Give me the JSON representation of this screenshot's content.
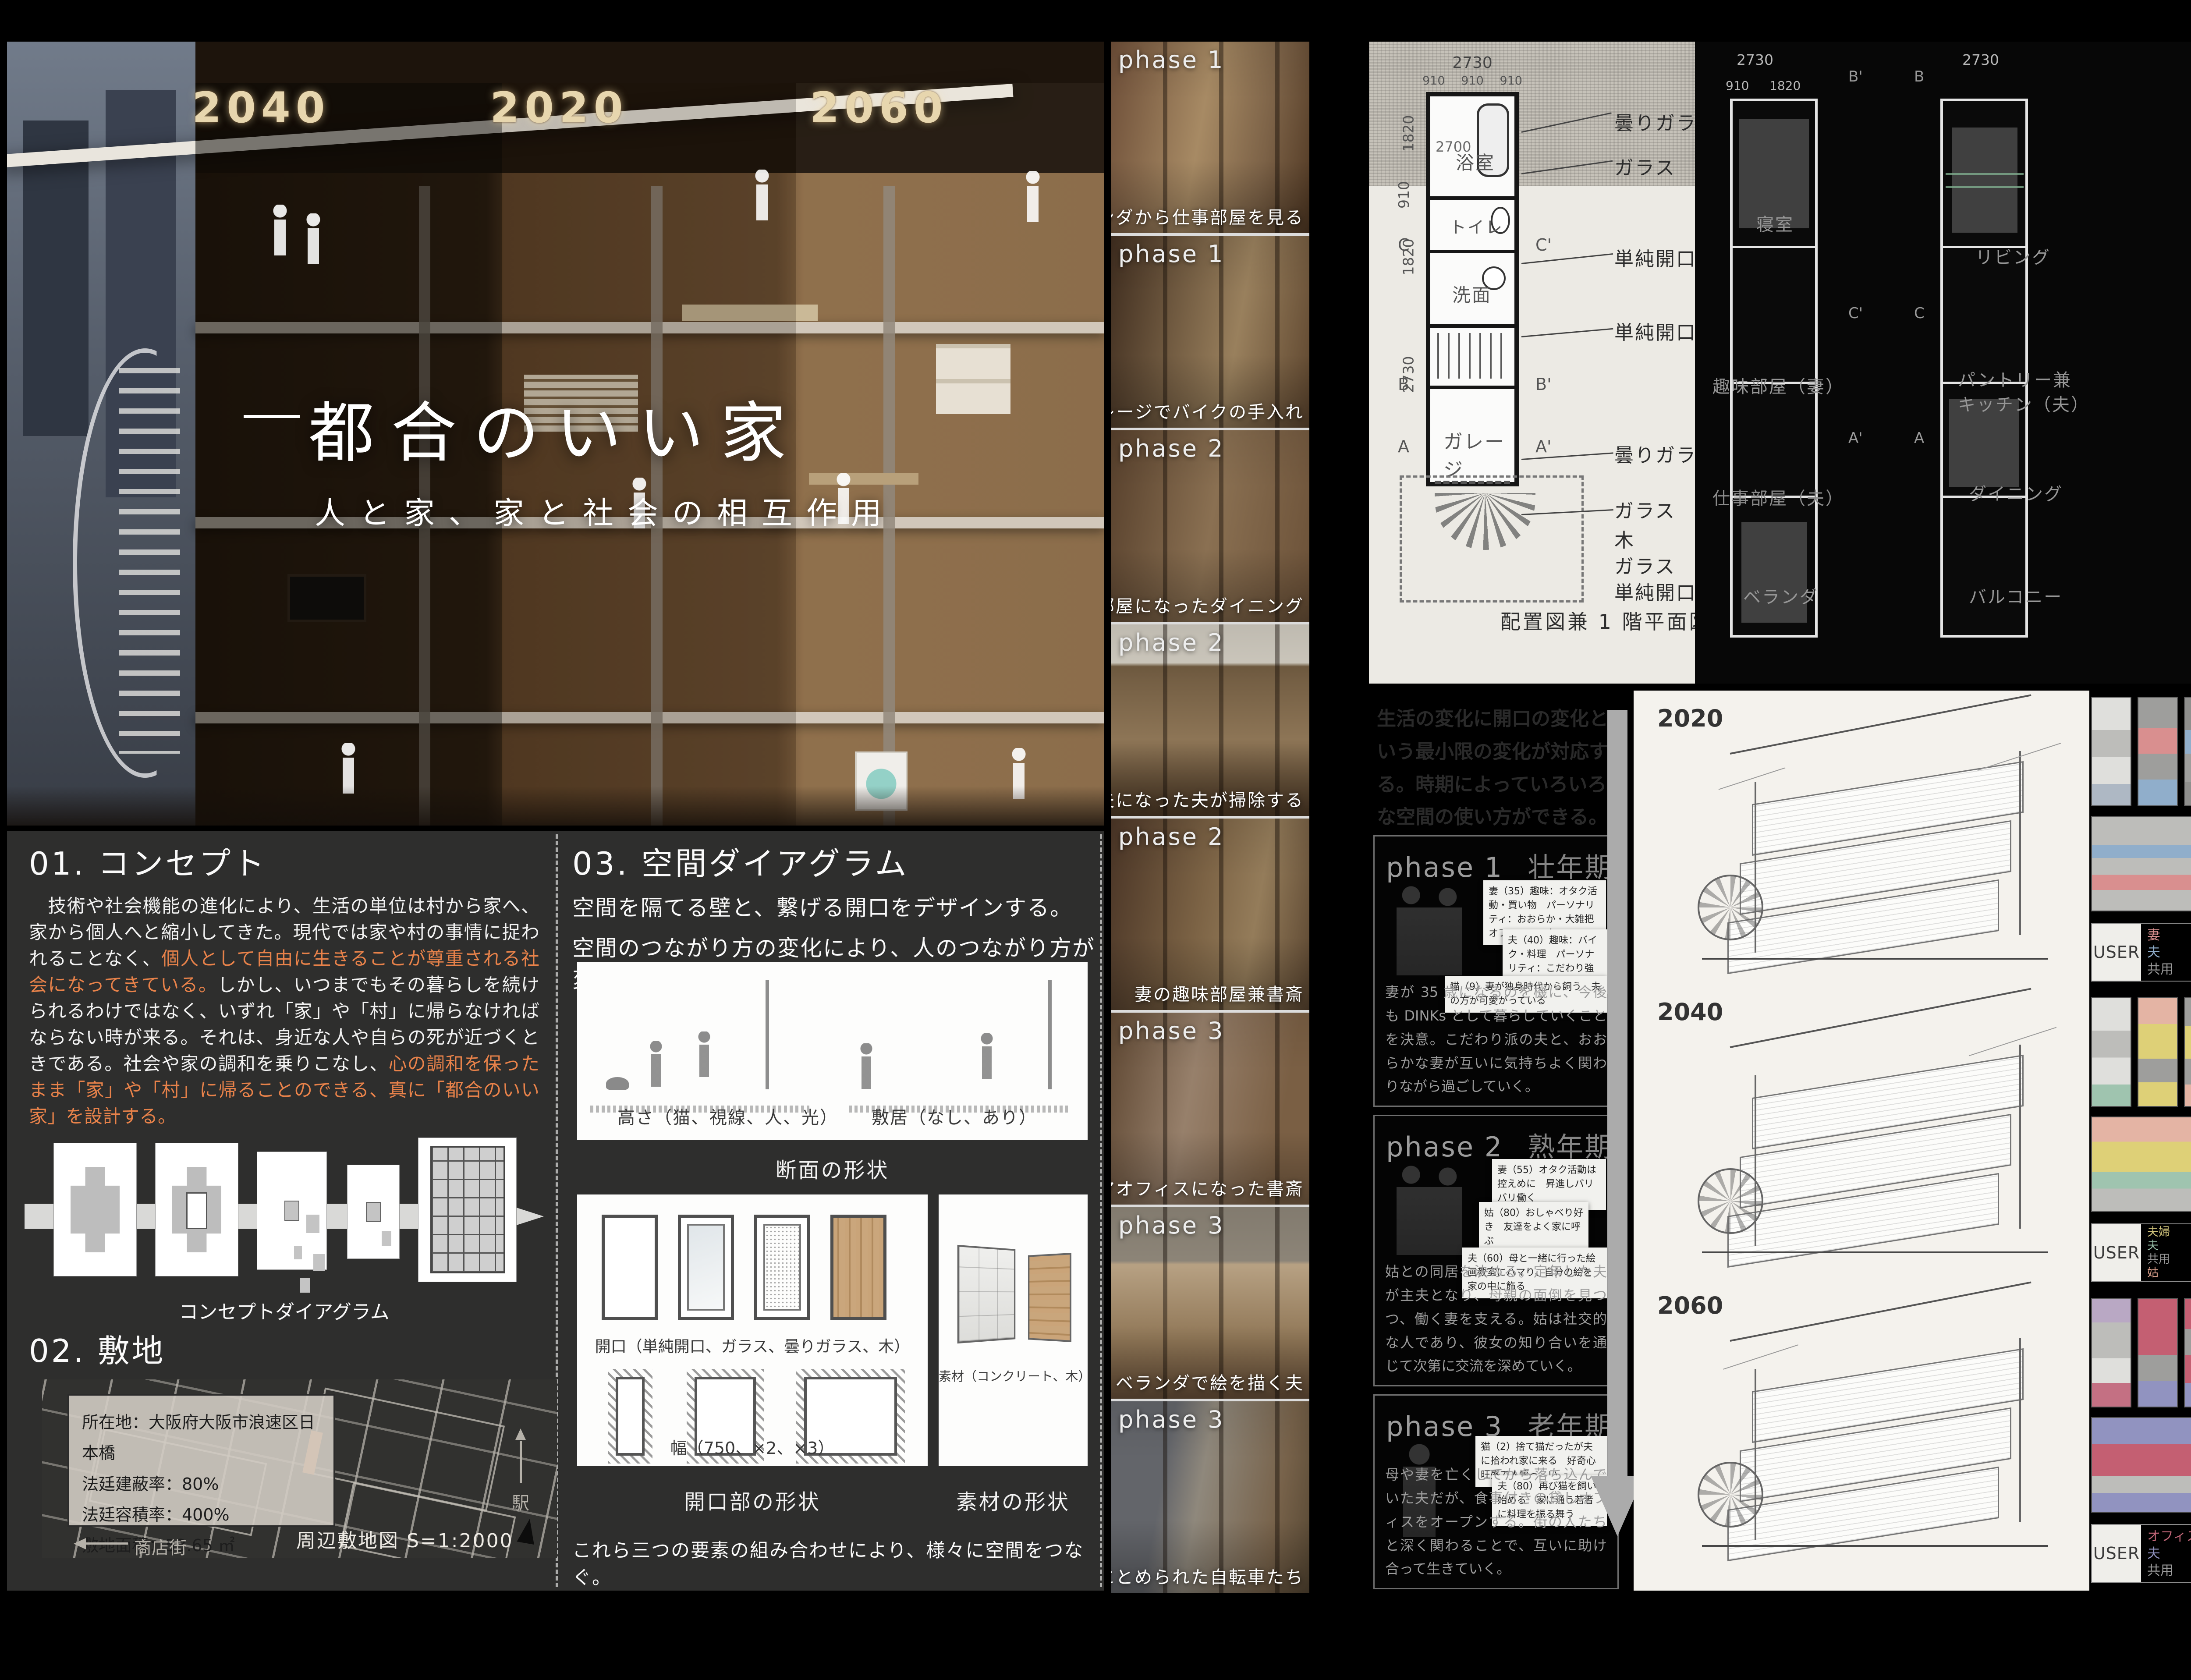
{
  "hero": {
    "years": [
      "2040",
      "2020",
      "2060"
    ],
    "title": "都合のいい家",
    "subtitle": "人と家、家と社会の相互作用"
  },
  "concept": {
    "heading": "01. コンセプト",
    "p1": "　技術や社会機能の進化により、生活の単位は村から家へ、家から個人へと縮小してきた。現代では家や村の事情に捉われることなく、",
    "p2": "個人として自由に生きることが尊重される社会になってきている。",
    "p3": "しかし、いつまでもその暮らしを続けられるわけではなく、いずれ「家」や「村」に帰らなければならない時が来る。それは、身近な人や自らの死が近づくときである。社会や家の調和を乗りこなし、",
    "p4": "心の調和を保ったまま「家」や「村」に帰ることのできる、真に「都合のいい家」を設計する。",
    "diagram_caption": "コンセプトダイアグラム"
  },
  "site": {
    "heading": "02. 敷地",
    "info1": "所在地：大阪府大阪市浪速区日本橋",
    "info2": "法廷建蔽率：80%",
    "info3": "法廷容積率：400%",
    "info4": "敷地面積：53.65 ㎡",
    "arcade": "商店街",
    "station": "駅",
    "caption": "周辺敷地図 S=1:2000"
  },
  "spatial": {
    "heading": "03. 空間ダイアグラム",
    "intro1": "空間を隔てる壁と、繋げる開口をデザインする。",
    "intro2": "空間のつながり方の変化により、人のつながり方が変化していく。",
    "cap_height": "高さ（猫、視線、人、光）",
    "cap_sill": "敷居（なし、あり）",
    "cap_section": "断面の形状",
    "cap_opening": "開口（単純開口、ガラス、曇りガラス、木）",
    "cap_width": "幅（750、×2、×3）",
    "cap_opening_shape": "開口部の形状",
    "cap_material": "素材（コンクリート、木）",
    "cap_material_shape": "素材の形状",
    "footer": "これら三つの要素の組み合わせにより、様々に空間をつなぐ。"
  },
  "photos": [
    {
      "phase": "phase 1",
      "caption": "ベランダから仕事部屋を見る"
    },
    {
      "phase": "phase 1",
      "caption": "ガレージでバイクの手入れ"
    },
    {
      "phase": "phase 2",
      "caption": "母の部屋になったダイニング"
    },
    {
      "phase": "phase 2",
      "caption": "専業主夫になった夫が掃除する"
    },
    {
      "phase": "phase 2",
      "caption": "妻の趣味部屋兼書斎"
    },
    {
      "phase": "phase 3",
      "caption": "シェアオフィスになった書斎"
    },
    {
      "phase": "phase 3",
      "caption": "ベランダで絵を描く夫"
    },
    {
      "phase": "phase 3",
      "caption": "ガレージにとめられた自転車たち"
    }
  ],
  "plan1f": {
    "dim_top": "2730",
    "dim_sub1": "910",
    "dim_sub2": "910",
    "dim_sub3": "910",
    "dim_left1": "1820",
    "dim_left2": "910",
    "dim_left3": "1820",
    "dim_left4": "2730",
    "dim_bath": "2700",
    "room_bath": "浴室",
    "room_toilet": "トイレ",
    "room_wash": "洗面",
    "room_garage": "ガレージ",
    "labels": [
      "曇りガラス",
      "ガラス",
      "単純開口",
      "単純開口",
      "曇りガラス",
      "ガラス",
      "木",
      "ガラス",
      "単純開口"
    ],
    "caption": "配置図兼 1 階平面図　S＝1:125",
    "sec_c": "C",
    "sec_c2": "C'",
    "sec_b": "B",
    "sec_b2": "B'",
    "sec_a": "A",
    "sec_a2": "A'"
  },
  "plan_upper": {
    "dim_top_l": "2730",
    "dim_sub_l": "910",
    "dim_sub_l2": "1820",
    "dim_top_r": "2730",
    "rooms2f": [
      "寝室",
      "趣味部屋（妻）",
      "仕事部屋（夫）",
      "ベランダ"
    ],
    "rooms3f": [
      "リビング",
      "パントリー兼",
      "キッチン（夫）",
      "ダイニング",
      "バルコニー"
    ]
  },
  "phases": {
    "intro": "生活の変化に開口の変化という最小限の変化が対応する。時期によっていろいろな空間の使い方ができる。",
    "items": [
      {
        "label": "phase 1",
        "stage": "壮年期",
        "notes": [
          "妻（35）趣味：オタク活動・買い物　パーソナリティ：おおらか・大雑把　オフィスワーク",
          "夫（40）趣味：バイク・料理　パーソナリティ：こだわり強め・極めたい",
          "猫（9）妻が独身時代から飼う　夫の方が可愛がっている"
        ],
        "desc": "妻が 35 歳になるのを機に、今後も DINKs として暮らしていくことを決意。こだわり派の夫と、おおらかな妻が互いに気持ちよく関わりながら過ごしていく。"
      },
      {
        "label": "phase 2",
        "stage": "熟年期",
        "notes": [
          "妻（55）オタク活動は控えめに　昇進しバリバリ働く",
          "姑（80）おしゃべり好き　友達をよく家に呼ぶ",
          "夫（60）母と一緒に行った絵画教室にハマり、自分の絵を家の中に飾る"
        ],
        "desc": "姑との同居を決める。定年した夫が主夫となり、母親の面倒を見つつ、働く妻を支える。姑は社交的な人であり、彼女の知り合いを通じて次第に交流を深めていく。"
      },
      {
        "label": "phase 3",
        "stage": "老年期",
        "notes": [
          "猫（2）捨て猫だったが夫に拾われ家に来る　好奇心旺盛で人懐っこい。",
          "夫（80）再び猫を飼い始める　家に通う若者に料理を振る舞う"
        ],
        "desc": "母や妻を亡くしてから落ち込んでいた夫だが、食事付きの貸しオフィスをオープンする。街の人たちと深く関わることで、互いに助け合って生きていく。"
      }
    ]
  },
  "timeline": {
    "y2020": "2020",
    "y2040": "2040",
    "y2060": "2060"
  },
  "users": [
    {
      "label": "USER",
      "e1": "妻",
      "e2": "夫",
      "e3": "共用",
      "e4": ""
    },
    {
      "label": "USER",
      "e1": "夫婦",
      "e2": "夫",
      "e3": "共用",
      "e4": "姑"
    },
    {
      "label": "USER",
      "e1": "オフィス",
      "e2": "夫",
      "e3": "共用",
      "e4": ""
    }
  ],
  "colors": {
    "accent_orange": "#e8824a",
    "panel_dark": "#2e2e2d",
    "wife_pink": "#d98f8f",
    "husband_blue": "#90aecb",
    "shared_gray": "#9a9a9a",
    "couple_yellow": "#cfc27a",
    "husband_green": "#97bfa7",
    "mother_salmon": "#dba08c",
    "office_crimson": "#c06577",
    "husband_purple": "#9193c0"
  }
}
